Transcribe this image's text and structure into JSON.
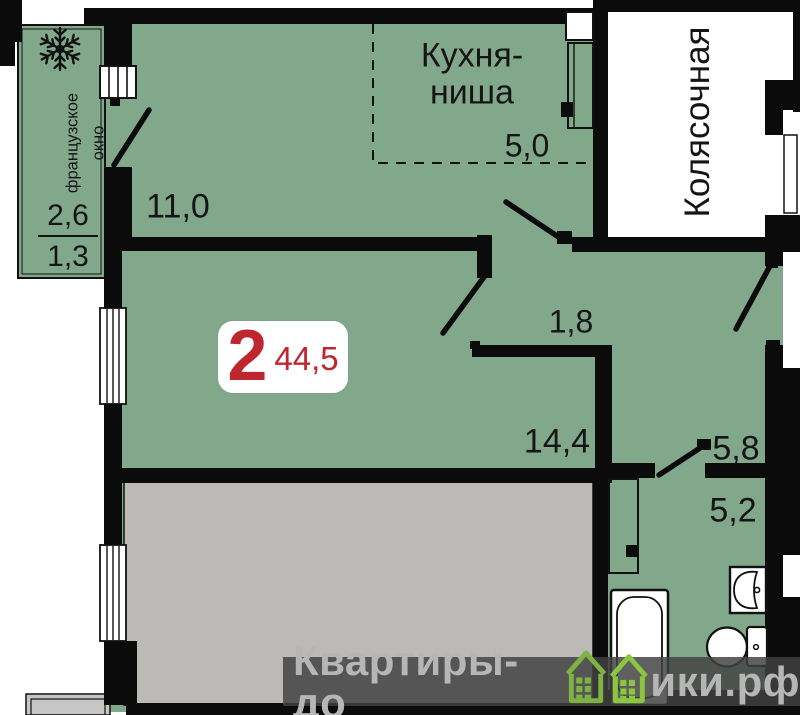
{
  "plan": {
    "title": "2-room apartment floor plan",
    "badge": {
      "rooms": "2",
      "area": "44,5"
    },
    "rooms": {
      "kitchen_niche": {
        "name": "Кухня-\nниша",
        "area": "5,0"
      },
      "room_11": {
        "area": "11,0"
      },
      "hall": {
        "area": "1,8"
      },
      "living": {
        "area": "14,4"
      },
      "corridor": {
        "area": "5,8"
      },
      "bathroom": {
        "area": "5,2"
      },
      "stroller_room": {
        "name": "Колясочная"
      },
      "loggia": {
        "name": "французское\nокно",
        "area_full": "2,6",
        "area_counted": "1,3"
      }
    },
    "icons": [
      "snowflake-icon",
      "bathtub-icon",
      "toilet-icon",
      "sink-icon",
      "door-swing-icon",
      "window-icon",
      "house-logo-icon"
    ],
    "watermark": {
      "text_left": "Квартиры-до",
      "text_right": "ики.рф"
    },
    "colors": {
      "room_fill": "#82A88B",
      "neighbor_fill": "#BCBAB8",
      "outside": "#FFFFFF",
      "wall": "#0B0B0B",
      "accent_red": "#BE2630",
      "logo_green": "#7CB342",
      "watermark_bg": "#424242",
      "watermark_text": "#B6B6B6"
    }
  }
}
